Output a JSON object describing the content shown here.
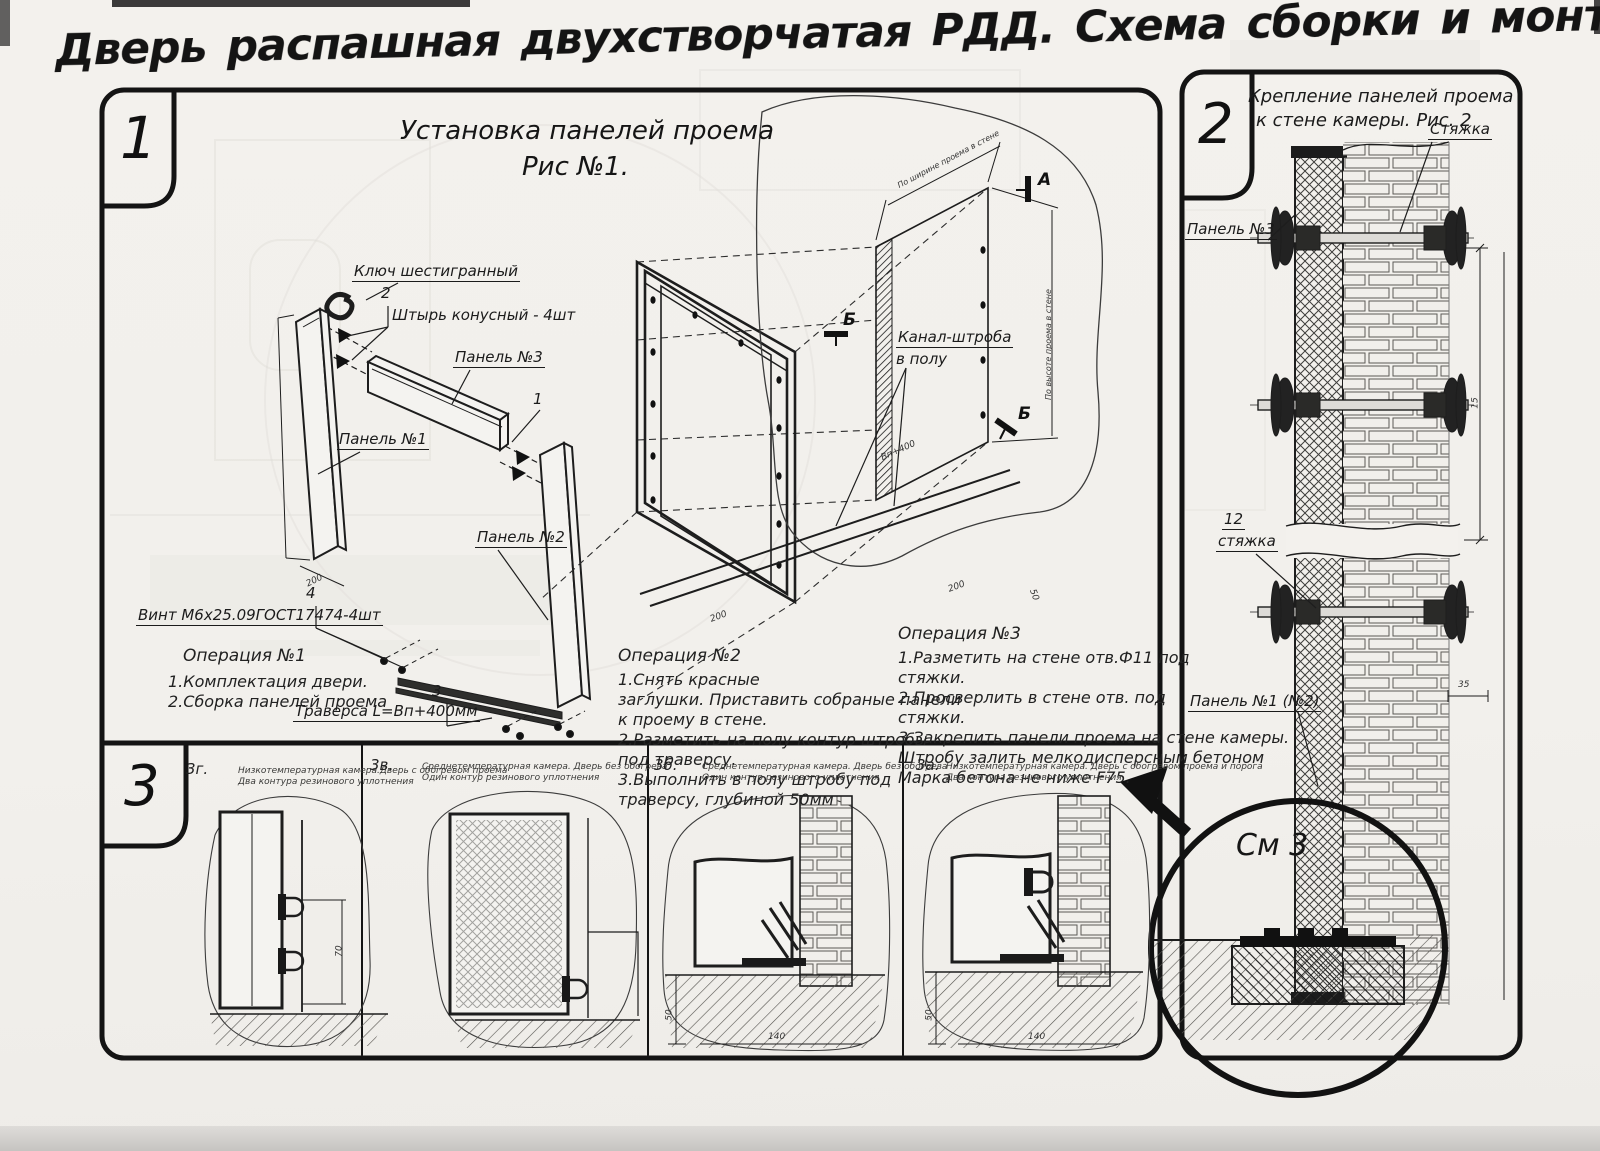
{
  "page": {
    "title": "Дверь распашная двухстворчатая РДД.  Схема сборки и монтажа №2"
  },
  "sections": {
    "s1": {
      "num": "1",
      "title1": "Установка панелей проема",
      "title2": "Рис №1.",
      "labels": {
        "hex_key": "Ключ шестигранный",
        "pin_num": "2",
        "pin": "Штырь конусный - 4шт",
        "panel3": "Панель №3",
        "panel1": "Панель №1",
        "panel2": "Панель №2",
        "item1": "1",
        "screw_num": "4",
        "screw": "Винт М6х25.09ГОСТ17474-4шт",
        "trav_num": "3",
        "traverse": "Траверса  L=Bп+400мм",
        "channel1": "Канал-штроба",
        "channel2": "в полу",
        "mark_a": "А",
        "mark_b1": "Б",
        "mark_b2": "Б",
        "dim_w": "По ширине проема в стене",
        "dim_h": "По высоте проема в стене"
      },
      "dims": {
        "d200a": "200",
        "d200b": "200",
        "d200c": "200",
        "d50": "50",
        "dbp": "Bп+400"
      },
      "op1": {
        "title": "Операция №1",
        "l1": "1.Комплектация двери.",
        "l2": "2.Сборка панелей проема"
      },
      "op2": {
        "title": "Операция №2",
        "l1": "1.Снять красные",
        "l2": "заглушки. Приставить собраные панели",
        "l3": "к проему в стене.",
        "l4": "2.Разметить на полу контур штробы",
        "l5": "под траверсу.",
        "l6": "3.Выполнить в полу штробу под",
        "l7": "траверсу, глубиной 50мм"
      },
      "op3": {
        "title": "Операция №3",
        "l1": "1.Разметить на стене отв.Ф11 под",
        "l2": "стяжки.",
        "l3": "2.Просверлить в стене отв.  под",
        "l4": "стяжки.",
        "l5": "3.Закрепить панели проема на стене камеры.",
        "l6": "Штробу залить мелкодисперсным бетоном",
        "l7": "Марка бетона не ниже  F75."
      }
    },
    "s2": {
      "num": "2",
      "title1": "Крепление панелей проема",
      "title2": "к стене камеры. Рис. 2",
      "labels": {
        "tie": "Стяжка",
        "panel3": "Панель №3",
        "pos12": "12",
        "tie2": "стяжка",
        "panel12": "Панель №1 (№2)",
        "see3": "См 3"
      },
      "dims": {
        "d15": "15",
        "d35": "35"
      }
    },
    "s3": {
      "num": "3",
      "cells": [
        {
          "code": "3г.",
          "d1": "Низкотемпературная камера.Дверь с обогревом проема",
          "d2": "Два контура резинового уплотнения"
        },
        {
          "code": "3в.",
          "d1": "Среднетемпературная камера. Дверь без обогрева",
          "d2": "Один контур резинового уплотнения"
        },
        {
          "code": "3б.",
          "d1": "Среднетемпературная камера. Дверь без обогрева",
          "d2": "Один контур резинового уплотнения"
        },
        {
          "code": "3а.",
          "d1": "Низкотемпературная камера. Дверь с обогревом проема и порога",
          "d2": "Два контура резинового уплотнения"
        }
      ],
      "dims": {
        "d70": "70",
        "d50a": "50",
        "d140a": "140",
        "d50b": "50",
        "d140b": "140"
      }
    }
  }
}
